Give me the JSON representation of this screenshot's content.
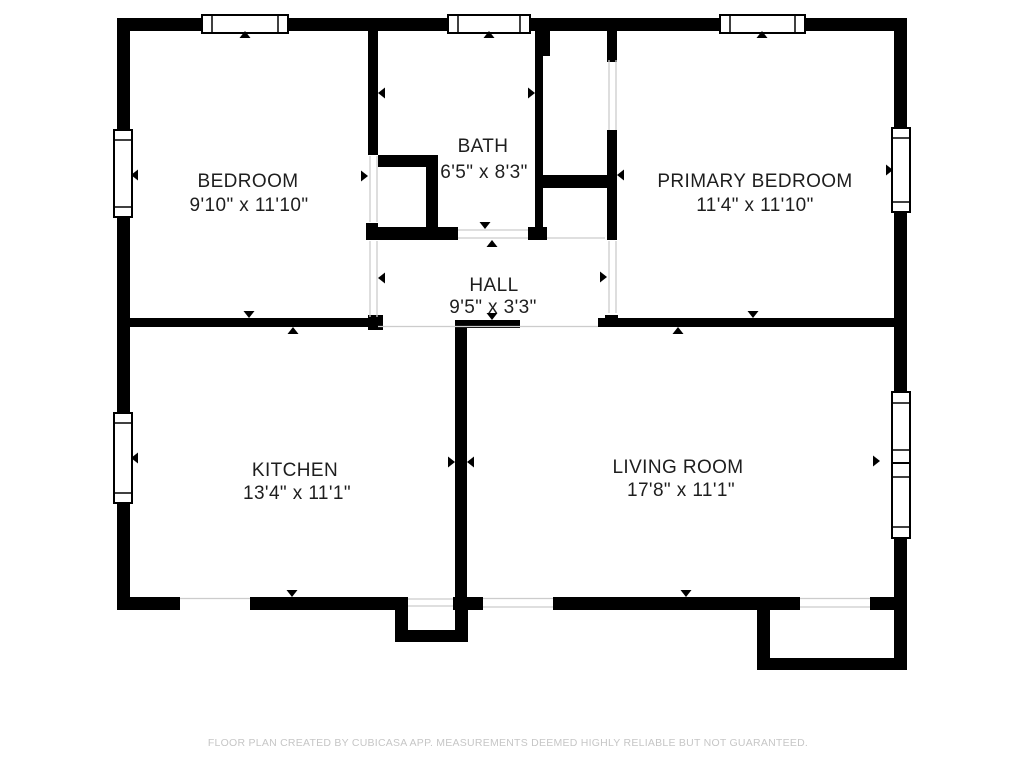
{
  "plan": {
    "rooms": [
      {
        "id": "bedroom",
        "name": "BEDROOM",
        "dimensions": "9'10\" x 11'10\""
      },
      {
        "id": "bath",
        "name": "BATH",
        "dimensions": "6'5\" x 8'3\""
      },
      {
        "id": "primary_bedroom",
        "name": "PRIMARY BEDROOM",
        "dimensions": "11'4\" x 11'10\""
      },
      {
        "id": "hall",
        "name": "HALL",
        "dimensions": "9'5\" x 3'3\""
      },
      {
        "id": "kitchen",
        "name": "KITCHEN",
        "dimensions": "13'4\" x 11'1\""
      },
      {
        "id": "living_room",
        "name": "LIVING ROOM",
        "dimensions": "17'8\" x 11'1\""
      }
    ],
    "footer": "FLOOR PLAN CREATED BY CUBICASA APP. MEASUREMENTS DEEMED HIGHLY RELIABLE BUT NOT GUARANTEED.",
    "colors": {
      "wall": "#000000",
      "text": "#1e1e1e",
      "footer_text": "#c6c6c6",
      "open_line": "#cccccc",
      "background": "#ffffff"
    }
  }
}
